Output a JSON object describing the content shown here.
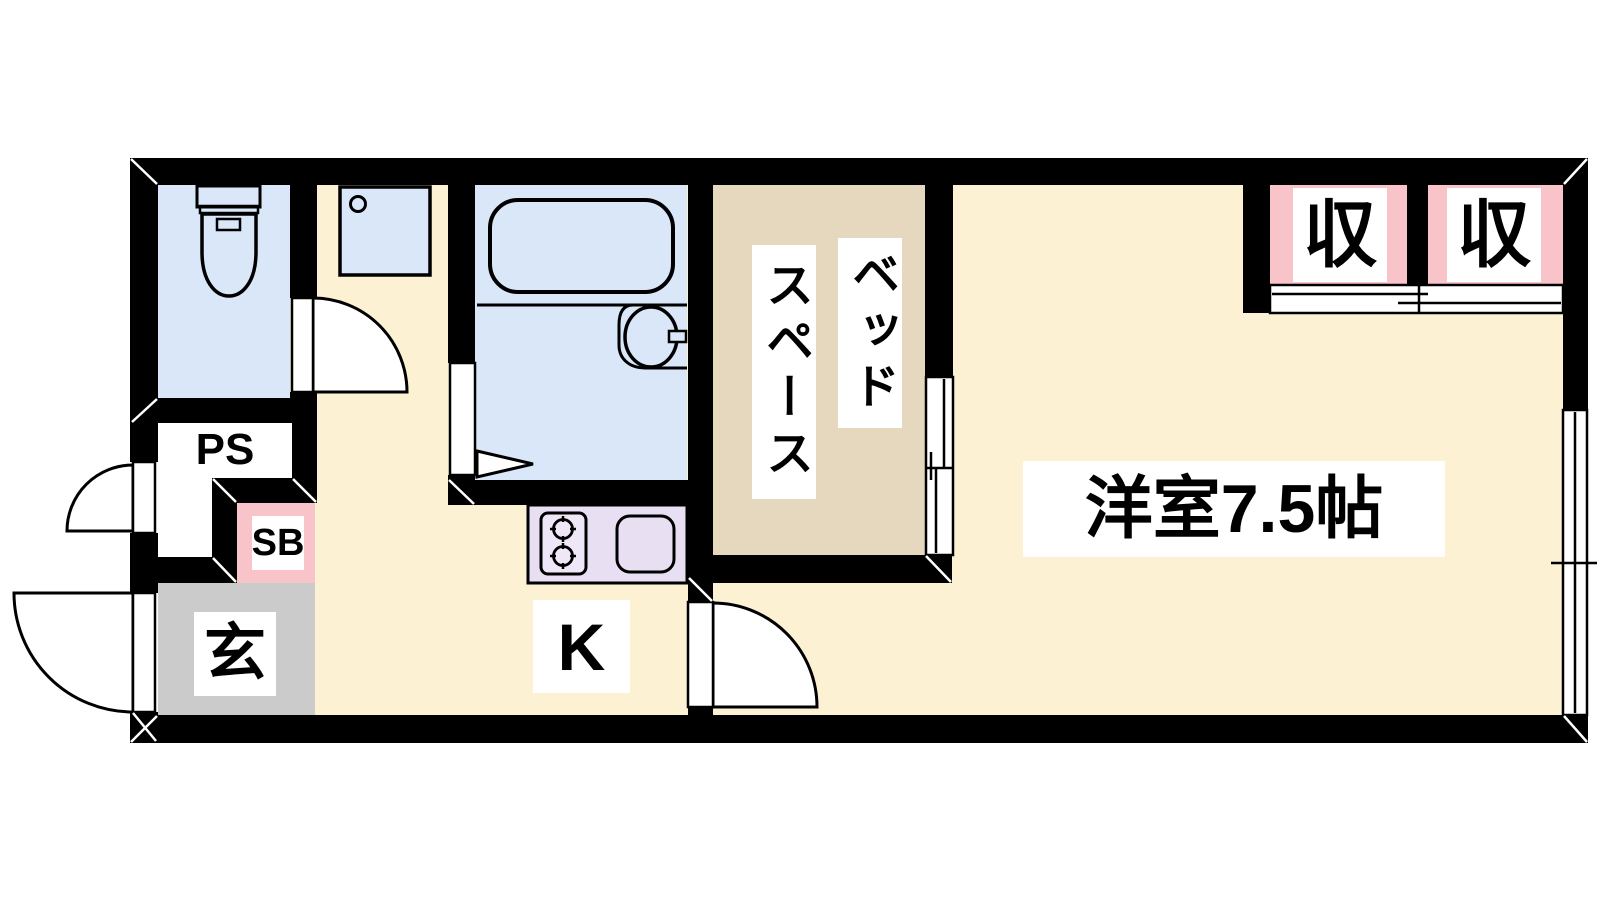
{
  "floorplan": {
    "rooms": {
      "western_room": {
        "label": "洋室7.5帖"
      },
      "bed_space": {
        "label_line1": "ベッド",
        "label_line2": "スペース"
      },
      "kitchen": {
        "label": "K"
      },
      "entrance": {
        "label": "玄"
      },
      "closets": [
        {
          "label": "収"
        },
        {
          "label": "収"
        }
      ],
      "pipe_space": {
        "label": "PS"
      },
      "shoe_box": {
        "label": "SB"
      }
    },
    "colors": {
      "floor_cream": "#FCF2D3",
      "floor_tan": "#E5D8BE",
      "floor_blue": "#D9E7F9",
      "floor_gray": "#CBCBCB",
      "accent_pink": "#F9C3CA",
      "counter_lavender": "#E9DFF2",
      "wall_black": "#000000"
    }
  }
}
